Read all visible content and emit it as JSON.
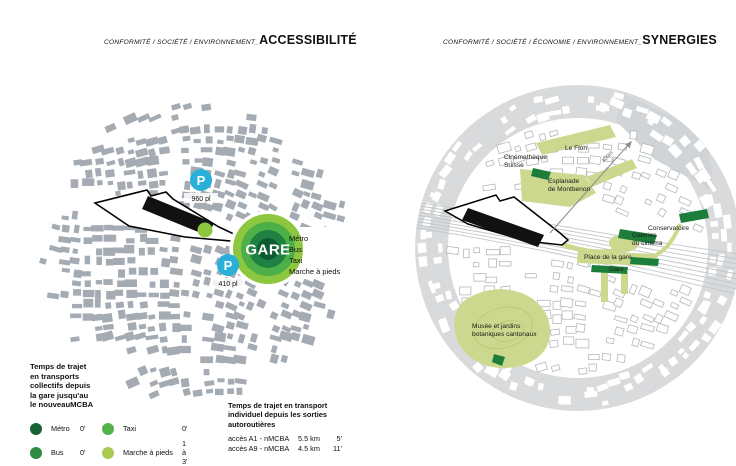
{
  "colors": {
    "building_gray": "#a5abb2",
    "ring_gray": "#d8dadb",
    "outline_gray": "#b2b8bd",
    "rail_gray": "#c2c6c9",
    "light_green": "#ccd88d",
    "dark_green": "#1d7e3c",
    "dot_green": "#8dc63f",
    "parking_blue": "#29afd8",
    "gare_rings": [
      "#8dc63f",
      "#4caf48",
      "#1e8041",
      "#0d5c31"
    ]
  },
  "left_panel": {
    "title_prefix": "CONFORMITÉ / SOCIÉTÉ / ENVIRONNEMENT_",
    "title_main": "ACCESSIBILITÉ",
    "map": {
      "gare_label": "GARE",
      "transport_modes": [
        "Métro",
        "Bus",
        "Taxi",
        "Marche à pieds"
      ],
      "parking_top": {
        "symbol": "P",
        "capacity": "960 pl"
      },
      "parking_bottom": {
        "symbol": "P",
        "capacity": "410 pl"
      }
    },
    "legend_collective": {
      "title_lines": [
        "Temps de trajet",
        "en transports",
        "collectifs depuis",
        "la gare jusqu'au",
        "le nouveauMCBA"
      ],
      "items": [
        {
          "label": "Métro",
          "value": "0'",
          "color": "#156232"
        },
        {
          "label": "Bus",
          "value": "0'",
          "color": "#2e8c40"
        },
        {
          "label": "Taxi",
          "value": "0'",
          "color": "#55b24a"
        },
        {
          "label": "Marche à pieds",
          "value": "1 à 3'",
          "color": "#a8ca52"
        }
      ]
    },
    "legend_individual": {
      "title_lines": [
        "Temps de trajet en transport",
        "individuel depuis les sorties",
        "autoroutières"
      ],
      "rows": [
        {
          "label": "accès A1 - nMCBA",
          "distance": "5.5 km",
          "time": "5'"
        },
        {
          "label": "accès A9 - nMCBA",
          "distance": "4.5 km",
          "time": "11'"
        }
      ]
    }
  },
  "right_panel": {
    "title_prefix": "CONFORMITÉ / SOCIÉTÉ / ÉCONOMIE / ENVIRONNEMENT_",
    "title_main": "SYNERGIES",
    "map_labels": [
      {
        "id": "le_flon",
        "text": "Le Flon"
      },
      {
        "id": "cinematheque",
        "text": "Cinémathèque\nSuisse"
      },
      {
        "id": "esplanade",
        "text": "Esplanade\nde Montbenon"
      },
      {
        "id": "conservatoire",
        "text": "Conservatoire"
      },
      {
        "id": "galeries",
        "text": "Galeries\ndu cinéma"
      },
      {
        "id": "place_gare",
        "text": "Place de la gare"
      },
      {
        "id": "gare",
        "text": "Gare"
      },
      {
        "id": "musee",
        "text": "Musée et jardins\nbotaniques cantonaux"
      },
      {
        "id": "distance_arrow",
        "text": "400m"
      }
    ]
  }
}
